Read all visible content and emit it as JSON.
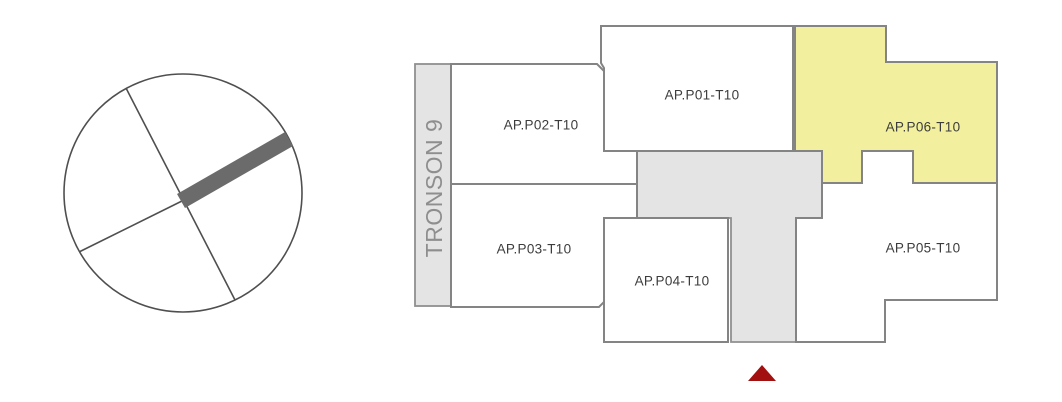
{
  "colors": {
    "background": "#ffffff",
    "room_fill": "#ffffff",
    "wall_stroke": "#848484",
    "common_area_fill": "#e4e4e4",
    "highlight_fill": "#f2f09e",
    "label_text": "#3c3c3c",
    "section_text": "#8e8e8e",
    "overview_outline": "#4f4f4f",
    "overview_segment": "#6b6b6b",
    "entrance_marker": "#a21010"
  },
  "floor_plan": {
    "section_label": "TRONSON 9",
    "apartments": [
      {
        "label": "AP.P01-T10",
        "highlighted": false
      },
      {
        "label": "AP.P02-T10",
        "highlighted": false
      },
      {
        "label": "AP.P03-T10",
        "highlighted": false
      },
      {
        "label": "AP.P04-T10",
        "highlighted": false
      },
      {
        "label": "AP.P05-T10",
        "highlighted": false
      },
      {
        "label": "AP.P06-T10",
        "highlighted": true
      }
    ]
  }
}
